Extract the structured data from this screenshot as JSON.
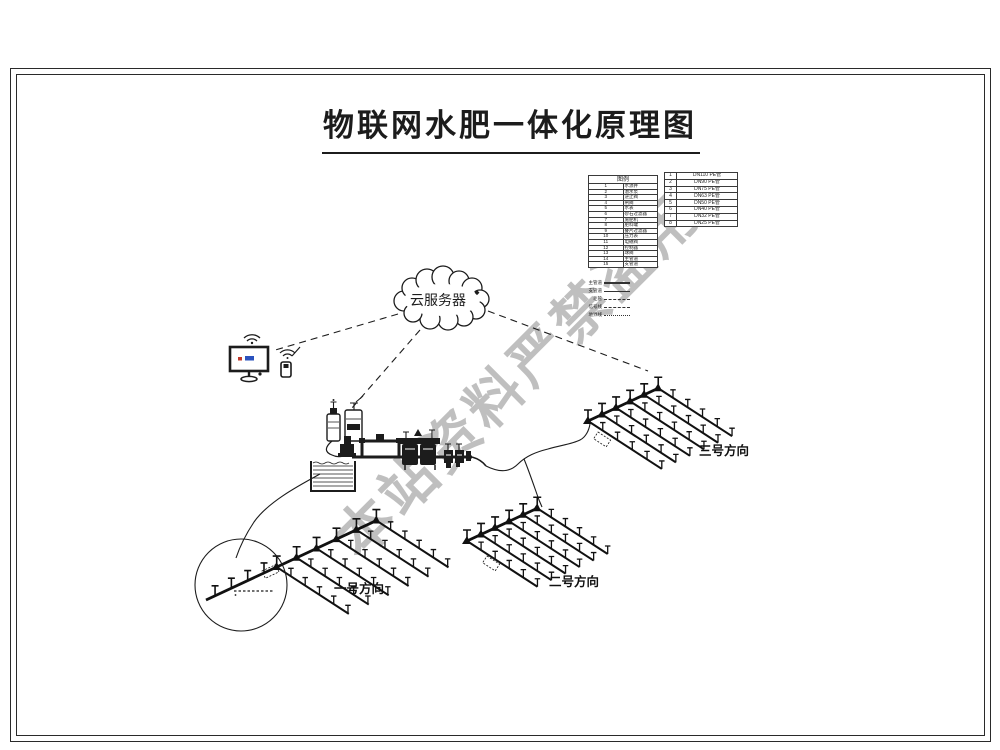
{
  "title": "物联网水肥一体化原理图",
  "watermark": "本站资料严禁盗用",
  "cloud_label": "云服务器",
  "colors": {
    "line": "#1c1c1c",
    "watermark": "#b0b0b0",
    "screen_red": "#c0392b",
    "screen_blue": "#2a52be"
  },
  "legend": {
    "header": "图例",
    "items": [
      {
        "no": "1",
        "name": "水源井"
      },
      {
        "no": "2",
        "name": "潜水泵"
      },
      {
        "no": "3",
        "name": "逆止阀"
      },
      {
        "no": "4",
        "name": "闸阀"
      },
      {
        "no": "5",
        "name": "水表"
      },
      {
        "no": "6",
        "name": "砂石过滤器"
      },
      {
        "no": "7",
        "name": "施肥机"
      },
      {
        "no": "8",
        "name": "肥料罐"
      },
      {
        "no": "9",
        "name": "叠片过滤器"
      },
      {
        "no": "10",
        "name": "压力表"
      },
      {
        "no": "11",
        "name": "电磁阀"
      },
      {
        "no": "12",
        "name": "控制器"
      },
      {
        "no": "13",
        "name": "球阀"
      },
      {
        "no": "14",
        "name": "主管道"
      },
      {
        "no": "15",
        "name": "支管道"
      }
    ]
  },
  "spec_table": {
    "items": [
      {
        "no": "1",
        "name": "DN110 PE管"
      },
      {
        "no": "2",
        "name": "DN90 PE管"
      },
      {
        "no": "3",
        "name": "DN75 PE管"
      },
      {
        "no": "4",
        "name": "DN63 PE管"
      },
      {
        "no": "5",
        "name": "DN50 PE管"
      },
      {
        "no": "6",
        "name": "DN40 PE管"
      },
      {
        "no": "7",
        "name": "DN32 PE管"
      },
      {
        "no": "8",
        "name": "DN25 PE管"
      }
    ]
  },
  "line_legend": [
    {
      "label": "主管道",
      "style": "solid-thick"
    },
    {
      "label": "支管道",
      "style": "solid"
    },
    {
      "label": "毛管",
      "style": "dashed"
    },
    {
      "label": "信号线",
      "style": "dashed"
    },
    {
      "label": "地界线",
      "style": "dotted"
    }
  ],
  "fields": [
    {
      "id": "field-1",
      "label": "一号方向",
      "label_x": 334,
      "label_y": 593,
      "ox": 206,
      "oy": 600,
      "main_len": 190,
      "pre_risers": [
        10,
        28,
        46,
        64
      ],
      "tap_start": 78,
      "tap_spacing": 22,
      "taps": 6,
      "lateral_len": 86,
      "riser_spacing": 17,
      "risers": 5,
      "tag_box": {
        "x": 262,
        "y": 571,
        "rot": -25
      }
    },
    {
      "id": "field-2",
      "label": "二号方向",
      "label_x": 549,
      "label_y": 586,
      "ox": 467,
      "oy": 541,
      "main_len": 78,
      "pre_risers": [],
      "tap_start": 0,
      "tap_spacing": 15.5,
      "taps": 6,
      "lateral_len": 84,
      "riser_spacing": 16.8,
      "risers": 5,
      "tag_box": {
        "x": 487,
        "y": 556,
        "rot": 33
      }
    },
    {
      "id": "field-3",
      "label": "三号方向",
      "label_x": 699,
      "label_y": 455,
      "ox": 588,
      "oy": 421,
      "main_len": 78,
      "pre_risers": [],
      "tap_start": 0,
      "tap_spacing": 15.5,
      "taps": 6,
      "lateral_len": 88,
      "riser_spacing": 17.6,
      "risers": 5,
      "tag_box": {
        "x": 598,
        "y": 432,
        "rot": 33
      }
    }
  ]
}
